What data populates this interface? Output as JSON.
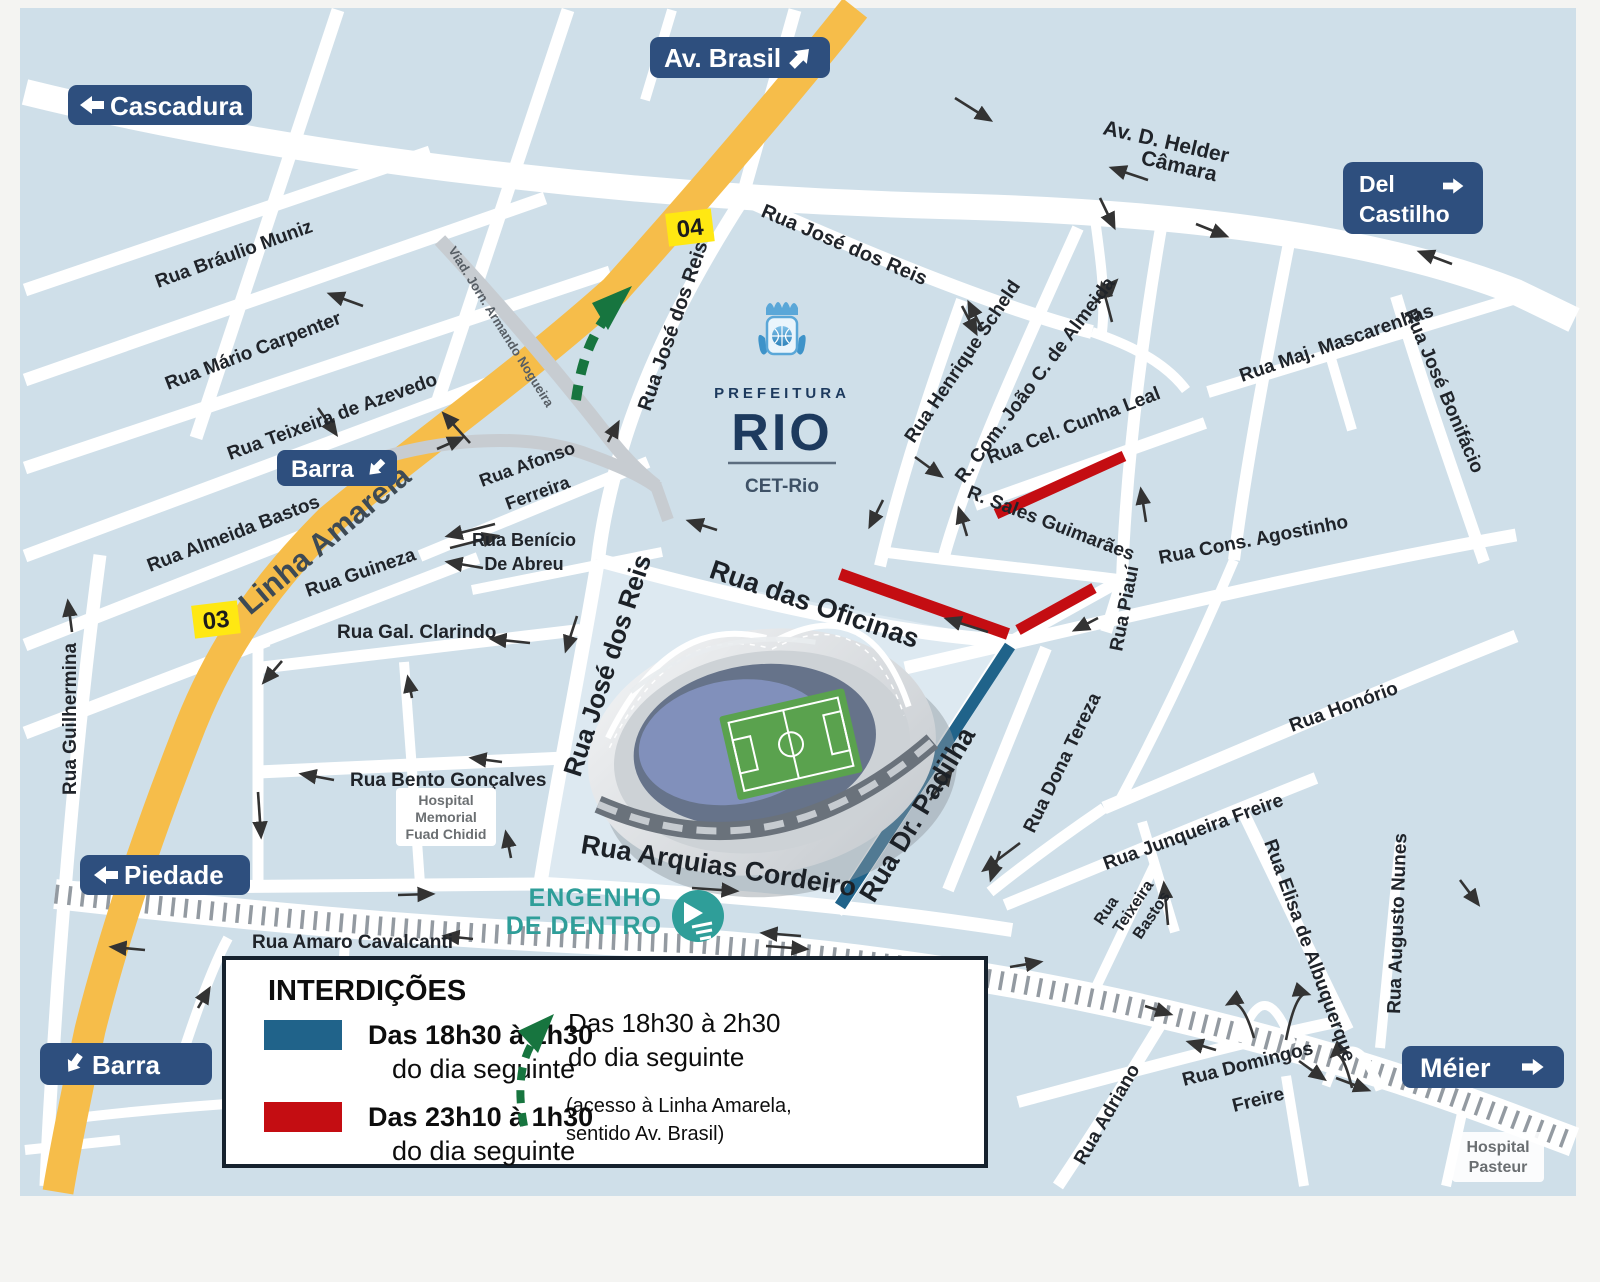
{
  "signs": {
    "cascadura": "Cascadura",
    "av_brasil": "Av. Brasil",
    "del_castilho_line1": "Del",
    "del_castilho_line2": "Castilho",
    "barra": "Barra",
    "piedade": "Piedade",
    "meier": "Méier"
  },
  "badges": {
    "exit_top": "04",
    "exit_mid": "03"
  },
  "logo": {
    "org": "PREFEITURA",
    "city": "RIO",
    "dept": "CET-Rio"
  },
  "station": {
    "line1": "ENGENHO",
    "line2": "DE DENTRO"
  },
  "hospitals": {
    "fuad_line1": "Hospital",
    "fuad_line2": "Memorial",
    "fuad_line3": "Fuad Chidid",
    "pasteur_line1": "Hospital",
    "pasteur_line2": "Pasteur"
  },
  "streets": {
    "braulio_muniz": "Rua Bráulio Muniz",
    "mario_carpenter": "Rua Mário Carpenter",
    "teixeira_de_azevedo": "Rua Teixeira de Azevedo",
    "almeida_bastos": "Rua Almeida Bastos",
    "guilhermina": "Rua Guilhermina",
    "linha_amarela": "Linha Amarela",
    "viaduto": "Viad. Jorn. Armando Nogueira",
    "jose_dos_reis": "Rua José dos Reis",
    "afonso_line1": "Rua Afonso",
    "afonso_line2": "Ferreira",
    "benicio_line1": "Rua Benício",
    "benicio_line2": "De Abreu",
    "guineza": "Rua Guineza",
    "gal_clarindo": "Rua Gal. Clarindo",
    "bento_goncalves": "Rua Bento Gonçalves",
    "oficinas": "Rua das Oficinas",
    "arquias_cordeiro": "Rua Arquias Cordeiro",
    "dr_padilha": "Rua Dr. Padilha",
    "henrique_scheld": "Rua Henrique Scheld",
    "joao_almeida": "R. Com. João C. de Almeida",
    "cunha_leal": "Rua Cel. Cunha Leal",
    "sales_guimaraes": "R. Sales Guimarães",
    "cons_agostinho": "Rua Cons. Agostinho",
    "maj_mascarenhas": "Rua Maj. Mascarenhas",
    "jose_bonifacio": "Rua José Bonifácio",
    "piaui": "Rua Piauí",
    "honorio": "Rua Honório",
    "dona_tereza": "Rua Dona Tereza",
    "junqueira_freire": "Rua Junqueira Freire",
    "teixeira_bastos_l1": "Rua",
    "teixeira_bastos_l2": "Teixeira",
    "teixeira_bastos_l3": "Bastos",
    "elisa_albuquerque": "Rua Elisa de Albuquerque",
    "augusto_nunes": "Rua Augusto Nunes",
    "adriano": "Rua Adriano",
    "domingos_line1": "Rua Domingos",
    "domingos_line2": "Freire",
    "helder_line1": "Av. D. Helder",
    "helder_line2": "Câmara",
    "amaro_cavalcanti": "Rua Amaro Cavalcanti"
  },
  "legend": {
    "title": "INTERDIÇÕES",
    "blue_time": "Das 18h30 à 1h30",
    "blue_suffix": "do dia seguinte",
    "red_time": "Das 23h10 à 1h30",
    "red_suffix": "do dia seguinte",
    "green_time": "Das 18h30 à 2h30",
    "green_suffix": "do dia seguinte",
    "green_note1": "(acesso à Linha Amarela,",
    "green_note2": "sentido Av. Brasil)"
  },
  "colors": {
    "map_bg": "#cfdfe9",
    "block_light": "#dde9f1",
    "street": "#ffffff",
    "linha_amarela": "#f6bd4a",
    "viaduct": "#c7ccd1",
    "railway_tick": "#939aa1",
    "sign_navy": "#2e4f7e",
    "closure_blue": "#20638a",
    "closure_red": "#c40d12",
    "green": "#17753f",
    "badge_yellow": "#ffe812",
    "station_teal": "#2f9e99",
    "logo_navy": "#1d3a5e"
  }
}
